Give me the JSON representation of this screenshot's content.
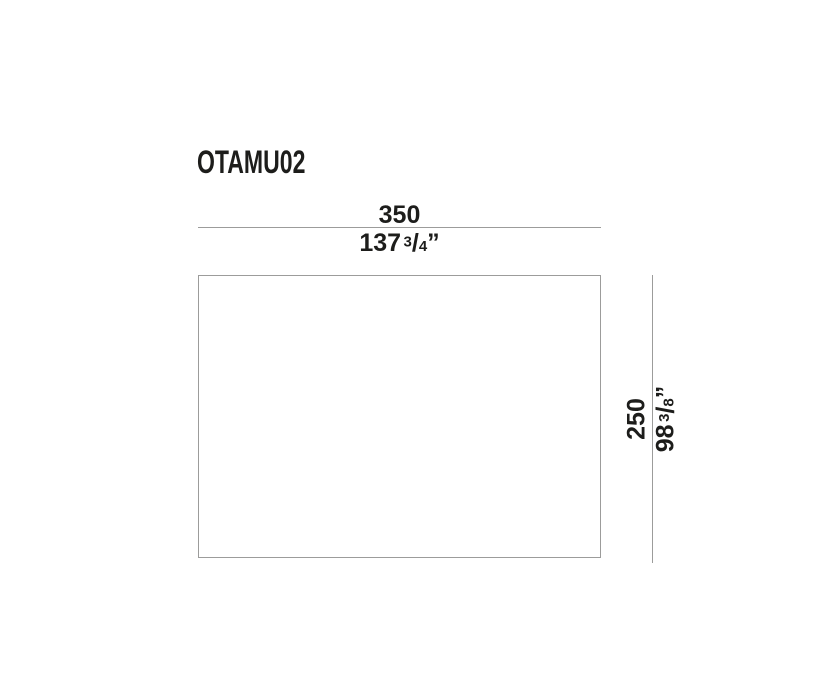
{
  "page": {
    "background": "#ffffff"
  },
  "drawing": {
    "product_code": "OTAMU02",
    "colors": {
      "text": "#1d1d1b",
      "line": "#9c9c9b"
    },
    "width_dimension": {
      "metric_value": "350",
      "imperial_whole": "137",
      "fraction_numerator": "3",
      "fraction_slash": "/",
      "fraction_denominator": "4",
      "unit_mark": "”"
    },
    "height_dimension": {
      "metric_value": "250",
      "imperial_whole": "98",
      "fraction_numerator": "3",
      "fraction_slash": "/",
      "fraction_denominator": "8",
      "unit_mark": "”"
    }
  }
}
